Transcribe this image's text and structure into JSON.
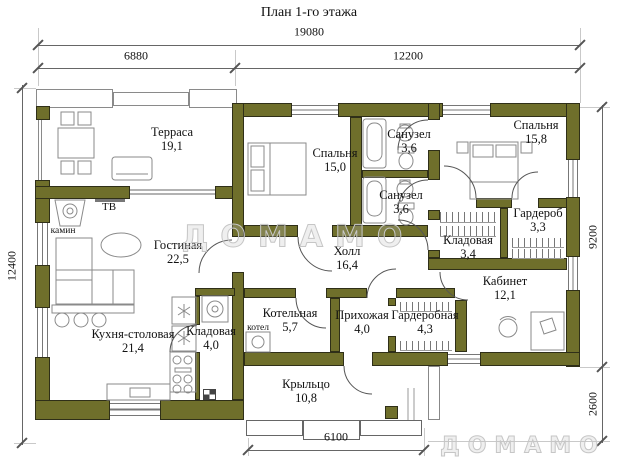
{
  "title": "План 1-го этажа",
  "watermarks": {
    "center": "ДОМАМО",
    "corner": "ДОМАМО"
  },
  "dimensions": {
    "top_total": "19080",
    "top_left": "6880",
    "top_right": "12200",
    "left": "12400",
    "right_main": "9200",
    "right_porch": "2600",
    "bottom_porch": "6100"
  },
  "rooms": [
    {
      "name": "Терраса",
      "area": "19,1"
    },
    {
      "name": "Гостиная",
      "area": "22,5"
    },
    {
      "name": "Кухня-столовая",
      "area": "21,4"
    },
    {
      "name": "Кладовая",
      "area": "4,0"
    },
    {
      "name": "Котельная",
      "area": "5,7"
    },
    {
      "name": "Прихожая",
      "area": "4,0"
    },
    {
      "name": "Гардеробная",
      "area": "4,3"
    },
    {
      "name": "Крыльцо",
      "area": "10,8"
    },
    {
      "name": "Холл",
      "area": "16,4"
    },
    {
      "name": "Спальня",
      "area": "15,0"
    },
    {
      "name": "Санузел",
      "area": "3,6"
    },
    {
      "name": "Санузел",
      "area": "3,6"
    },
    {
      "name": "Спальня",
      "area": "15,8"
    },
    {
      "name": "Гардероб",
      "area": "3,3"
    },
    {
      "name": "Кладовая",
      "area": "3,4"
    },
    {
      "name": "Кабинет",
      "area": "12,1"
    }
  ],
  "labels": {
    "tv": "ТВ",
    "fireplace": "камин",
    "boiler": "котел"
  },
  "colors": {
    "wall": "#6f6f2b",
    "line": "#555555",
    "furniture": "#8a8a8a",
    "watermark": "#c6c6c6"
  }
}
